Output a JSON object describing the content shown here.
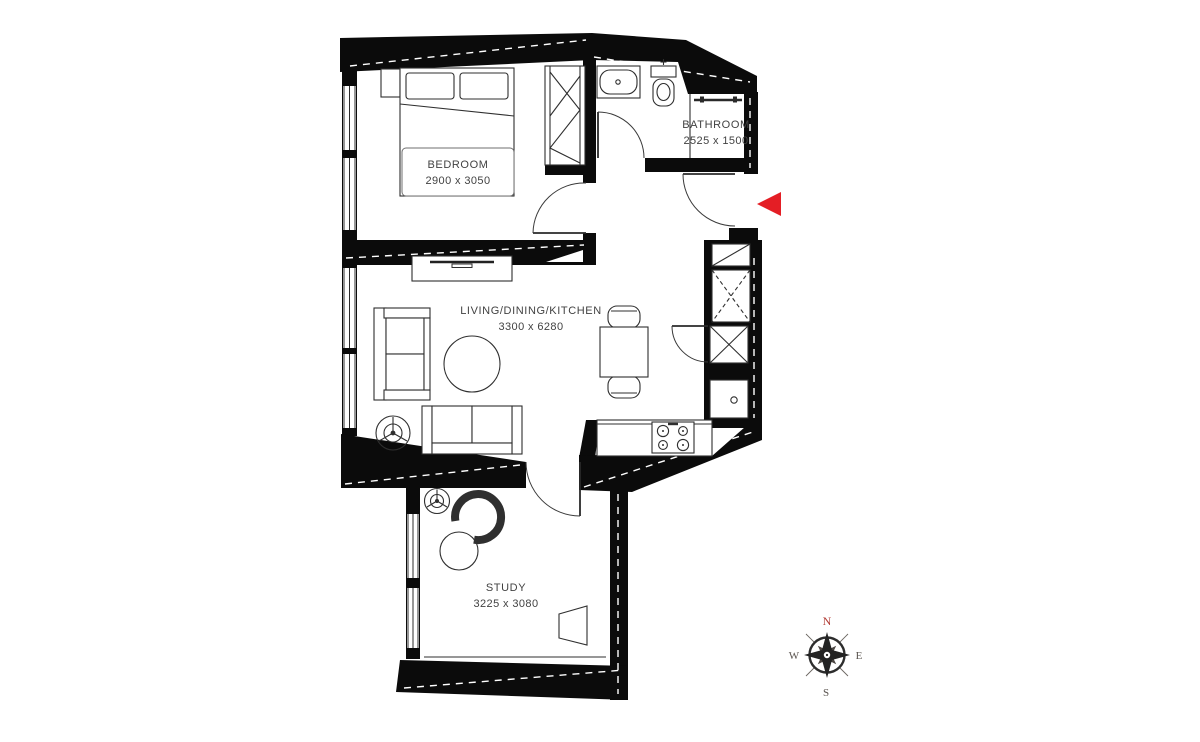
{
  "plan": {
    "rooms": {
      "bedroom": {
        "label": "BEDROOM",
        "dimensions": "2900 x 3050"
      },
      "bathroom": {
        "label": "BATHROOM",
        "dimensions": "2525 x 1500"
      },
      "living": {
        "label": "LIVING/DINING/KITCHEN",
        "dimensions": "3300 x 6280"
      },
      "study": {
        "label": "STUDY",
        "dimensions": "3225 x 3080"
      }
    },
    "colors": {
      "wall": "#0b0b0b",
      "furniture_line": "#2f2f2f",
      "label_text": "#424242",
      "entrance_marker": "#e41e25",
      "compass_north": "#b23d36",
      "compass_letters": "#5a544f"
    }
  },
  "compass": {
    "north": "N",
    "east": "E",
    "south": "S",
    "west": "W"
  }
}
